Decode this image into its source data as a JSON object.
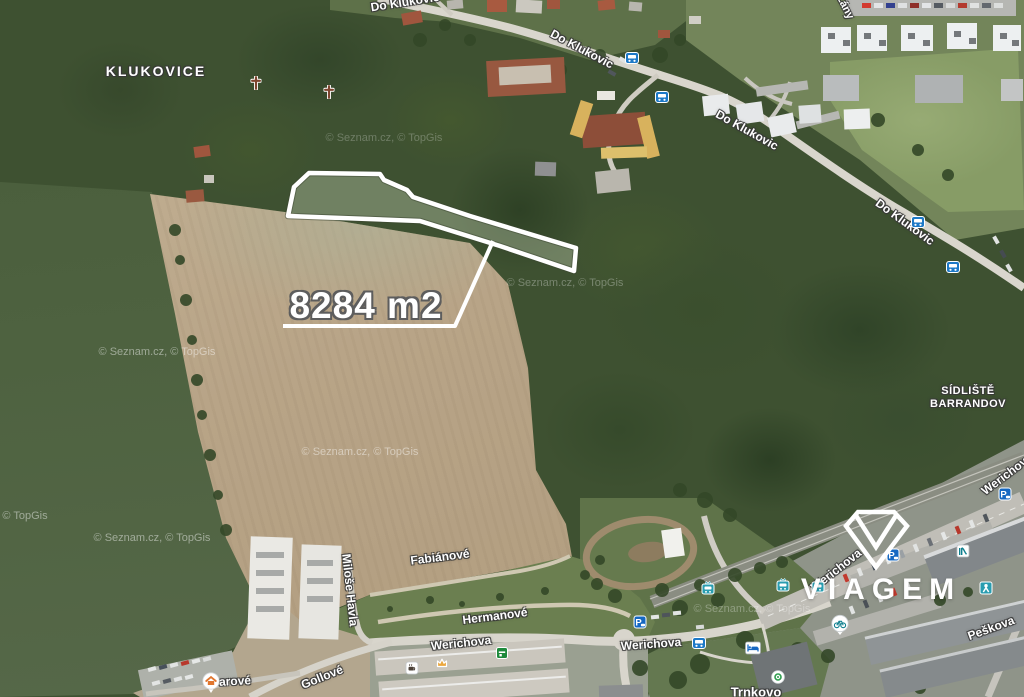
{
  "place_labels": {
    "klukovice": "KLUKOVICE",
    "sidliste_line1": "SÍDLIŠTĚ",
    "sidliste_line2": "BARRANDOV"
  },
  "streets": [
    {
      "text": "Do Klukovic"
    },
    {
      "text": "Do Klukovic"
    },
    {
      "text": "Do Klukovic"
    },
    {
      "text": "Do Klukovic"
    },
    {
      "text": "Fabiánové"
    },
    {
      "text": "Hermanové"
    },
    {
      "text": "Werichova"
    },
    {
      "text": "Werichova"
    },
    {
      "text": "Werichova"
    },
    {
      "text": "Werichova"
    },
    {
      "text": "Gollové"
    },
    {
      "text": "Miloše Havla"
    },
    {
      "text": "Trnkovo"
    },
    {
      "text": "Peškova"
    },
    {
      "text": "Lány"
    },
    {
      "text": "arové"
    }
  ],
  "plot": {
    "area_label": "8284 m2"
  },
  "watermarks": {
    "seznam_topgis": "© Seznam.cz, © TopGis",
    "topgis": "© TopGis"
  },
  "logo": {
    "text": "VIAGEM"
  },
  "icons": {
    "parking_letter": "P",
    "types": [
      "bus-stop",
      "tram-stop",
      "parking",
      "wayside-cross",
      "hotel-bed",
      "slide",
      "playground",
      "bicycle",
      "house",
      "cafe",
      "crown",
      "store",
      "pharmacy-circle"
    ]
  },
  "colors": {
    "plot_outline": "#ffffff",
    "bus_blue": "#1d79c7",
    "tram_teal": "#2a9db0",
    "parking_blue": "#1668c2",
    "label_white": "#ffffff"
  }
}
